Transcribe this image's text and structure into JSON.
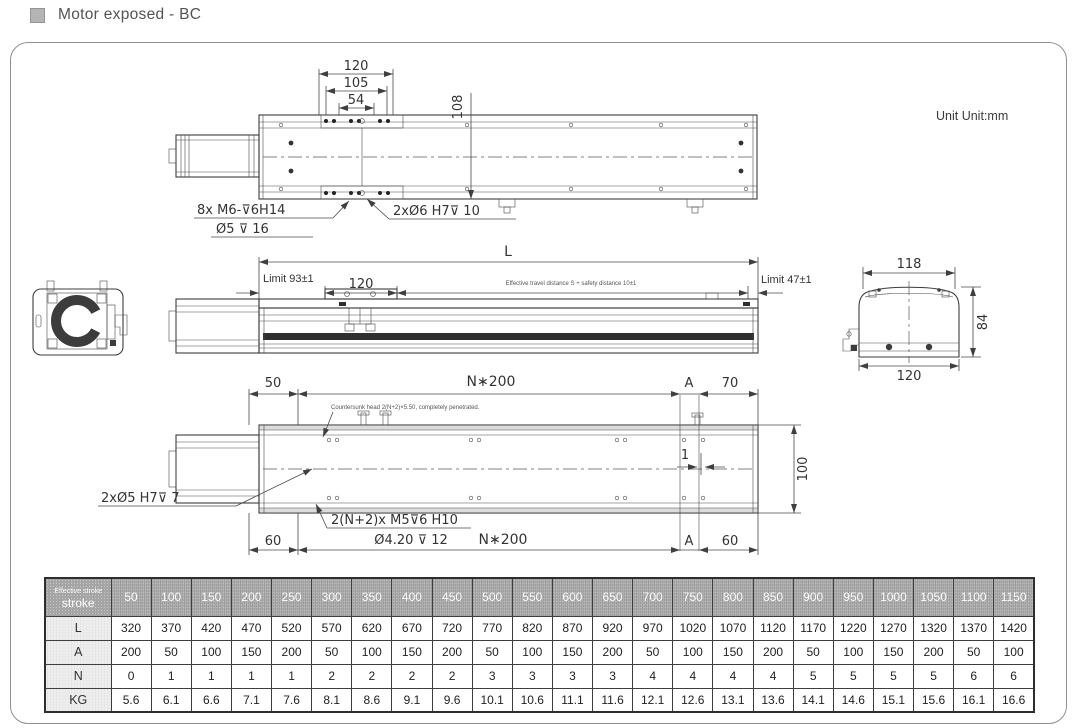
{
  "header": {
    "title": "Motor exposed - BC"
  },
  "unit_label": "Unit Unit:mm",
  "annotations": {
    "top_view": {
      "dim_120": "120",
      "dim_105": "105",
      "dim_54": "54",
      "dim_108": "108",
      "note_m6": "8x M6-⊽6H14",
      "note_phi5": "Ø5 ⊽ 16",
      "note_phi6": "2xØ6 H7⊽ 10"
    },
    "side_view": {
      "dim_L": "L",
      "limit_left": "Limit 93±1",
      "dim_120": "120",
      "travel_note": "Effective travel distance S + safety distance 10±1",
      "limit_right": "Limit 47±1"
    },
    "end_view": {
      "dim_118": "118",
      "dim_84": "84",
      "dim_120": "120"
    },
    "bottom_view": {
      "dim_50": "50",
      "dim_n200_top": "N∗200",
      "label_a_top": "A",
      "dim_70": "70",
      "note_countersunk": "Countersunk head 2(N+2)×5.50, completely penetrated.",
      "dim_100": "100",
      "dim_1": "1",
      "note_phi5h7": "2xØ5 H7⊽ 7",
      "note_m5": "2(N+2)x M5⊽6 H10",
      "note_phi420": "Ø4.20 ⊽ 12",
      "dim_n200_bottom": "N∗200",
      "dim_60_left": "60",
      "label_a_bottom": "A",
      "dim_60_right": "60"
    }
  },
  "table": {
    "header_small": "Effective stroke",
    "header_label": "stroke",
    "strokes": [
      "50",
      "100",
      "150",
      "200",
      "250",
      "300",
      "350",
      "400",
      "450",
      "500",
      "550",
      "600",
      "650",
      "700",
      "750",
      "800",
      "850",
      "900",
      "950",
      "1000",
      "1050",
      "1100",
      "1150"
    ],
    "rows": [
      {
        "label": "L",
        "values": [
          "320",
          "370",
          "420",
          "470",
          "520",
          "570",
          "620",
          "670",
          "720",
          "770",
          "820",
          "870",
          "920",
          "970",
          "1020",
          "1070",
          "1120",
          "1170",
          "1220",
          "1270",
          "1320",
          "1370",
          "1420"
        ]
      },
      {
        "label": "A",
        "values": [
          "200",
          "50",
          "100",
          "150",
          "200",
          "50",
          "100",
          "150",
          "200",
          "50",
          "100",
          "150",
          "200",
          "50",
          "100",
          "150",
          "200",
          "50",
          "100",
          "150",
          "200",
          "50",
          "100"
        ]
      },
      {
        "label": "N",
        "values": [
          "0",
          "1",
          "1",
          "1",
          "1",
          "2",
          "2",
          "2",
          "2",
          "3",
          "3",
          "3",
          "3",
          "4",
          "4",
          "4",
          "4",
          "5",
          "5",
          "5",
          "5",
          "6",
          "6"
        ]
      },
      {
        "label": "KG",
        "values": [
          "5.6",
          "6.1",
          "6.6",
          "7.1",
          "7.6",
          "8.1",
          "8.6",
          "9.1",
          "9.6",
          "10.1",
          "10.6",
          "11.1",
          "11.6",
          "12.1",
          "12.6",
          "13.1",
          "13.6",
          "14.1",
          "14.6",
          "15.1",
          "15.6",
          "16.1",
          "16.6"
        ]
      }
    ]
  },
  "colors": {
    "line": "#3c3c3c",
    "table_header_bg": "#aeaeae",
    "row_label_bg": "#ededed"
  }
}
